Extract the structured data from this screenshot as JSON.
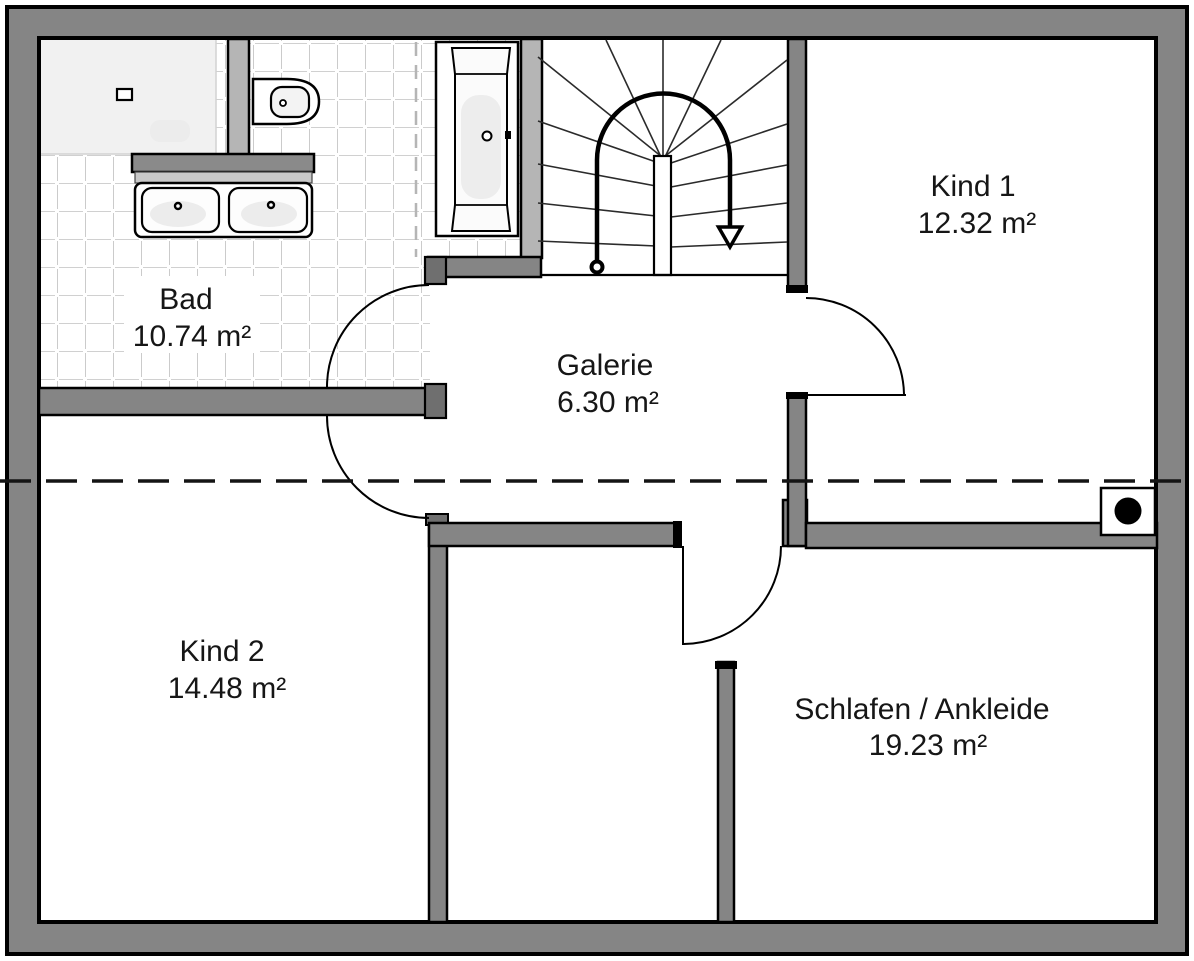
{
  "rooms": [
    {
      "id": "bad",
      "name": "Bad",
      "area": "10.74 m²"
    },
    {
      "id": "kind1",
      "name": "Kind 1",
      "area": "12.32 m²"
    },
    {
      "id": "galerie",
      "name": "Galerie",
      "area": "6.30 m²"
    },
    {
      "id": "kind2",
      "name": "Kind 2",
      "area": "14.48 m²"
    },
    {
      "id": "schlafen",
      "name": "Schlafen / Ankleide",
      "area": "19.23 m²"
    }
  ],
  "symbols": {
    "stair_arrow": "stair-direction-down-arrow",
    "staircase": "winder-staircase",
    "chimney": "chimney-flue-symbol",
    "roof_line": "roof-slope-dashed-line",
    "door": "door-swing-arc",
    "fixtures": [
      "shower-tray",
      "toilet",
      "double-washbasin",
      "bathtub"
    ]
  },
  "colors": {
    "wall": "#858585",
    "wall_light": "#b5b5b5",
    "outline": "#000000",
    "tile_line": "#a0a0a0",
    "fixture_fill": "#f1f1f1",
    "background": "#ffffff",
    "text": "#161616"
  }
}
